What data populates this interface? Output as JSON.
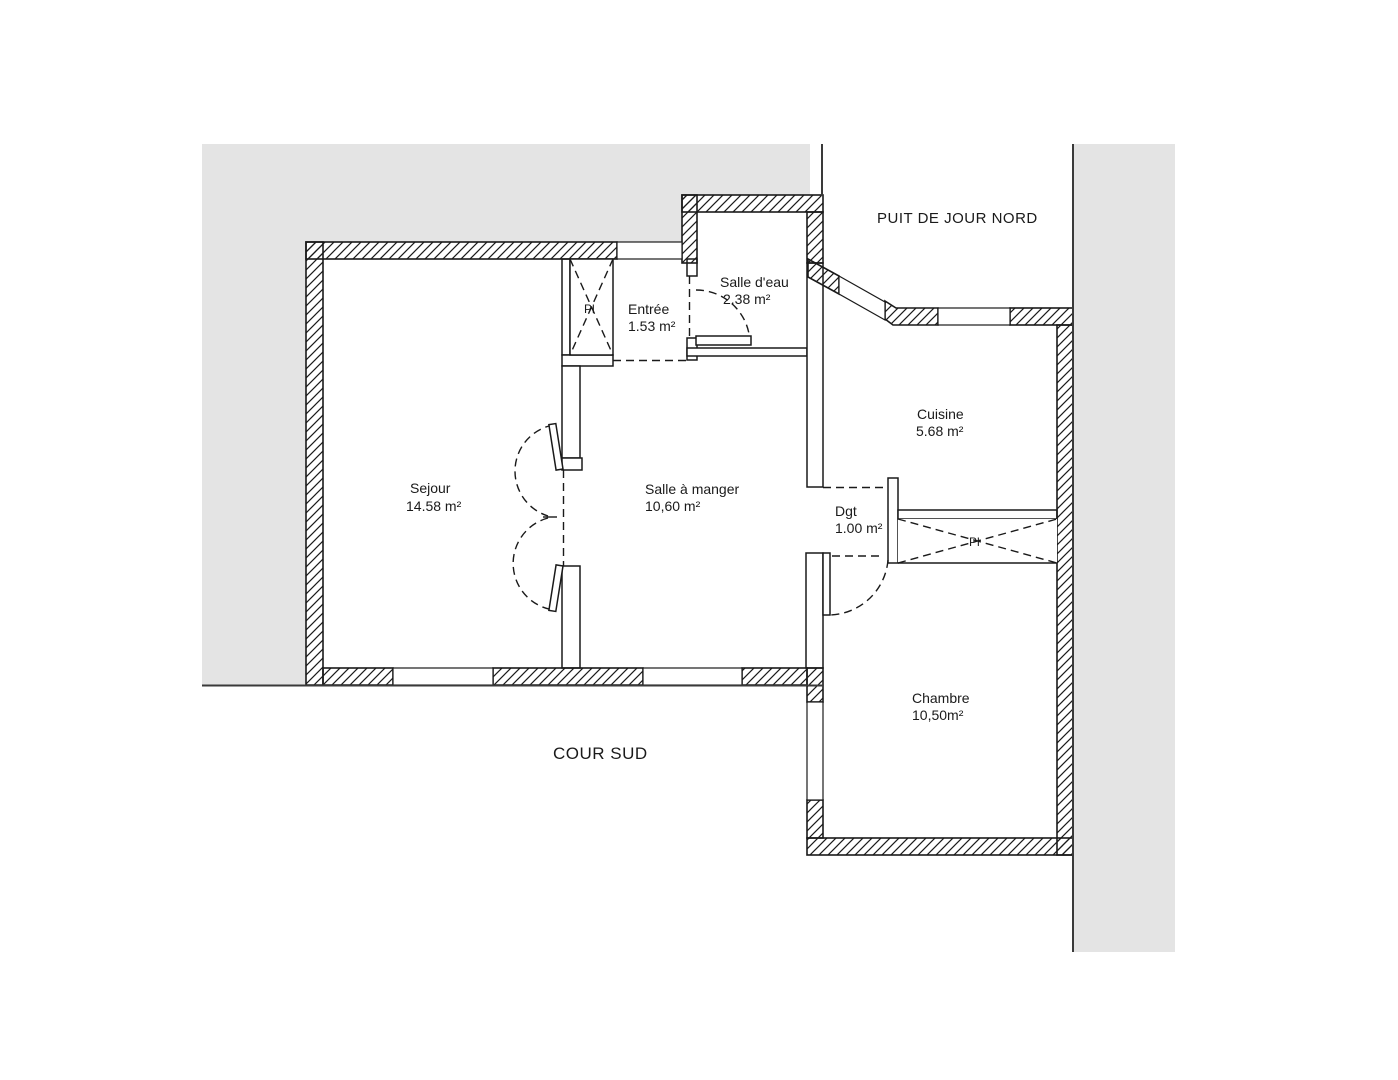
{
  "plan": {
    "outside": {
      "north_label": "PUIT DE JOUR NORD",
      "south_label": "COUR SUD"
    },
    "rooms": [
      {
        "name": "Sejour",
        "area": "14.58 m²"
      },
      {
        "name": "Entrée",
        "area": "1.53 m²"
      },
      {
        "name": "Salle d'eau",
        "area": "2.38 m²"
      },
      {
        "name": "Salle à manger",
        "area": "10,60 m²"
      },
      {
        "name": "Cuisine",
        "area": "5.68 m²"
      },
      {
        "name": "Dgt",
        "area": "1.00 m²"
      },
      {
        "name": "Chambre",
        "area": "10,50m²"
      }
    ],
    "closets": [
      {
        "label": "Pl"
      },
      {
        "label": "Pl"
      }
    ],
    "colors": {
      "courtyard_grey": "#e4e4e4",
      "line": "#1a1a1a",
      "wall_interior": "#ffffff"
    }
  }
}
